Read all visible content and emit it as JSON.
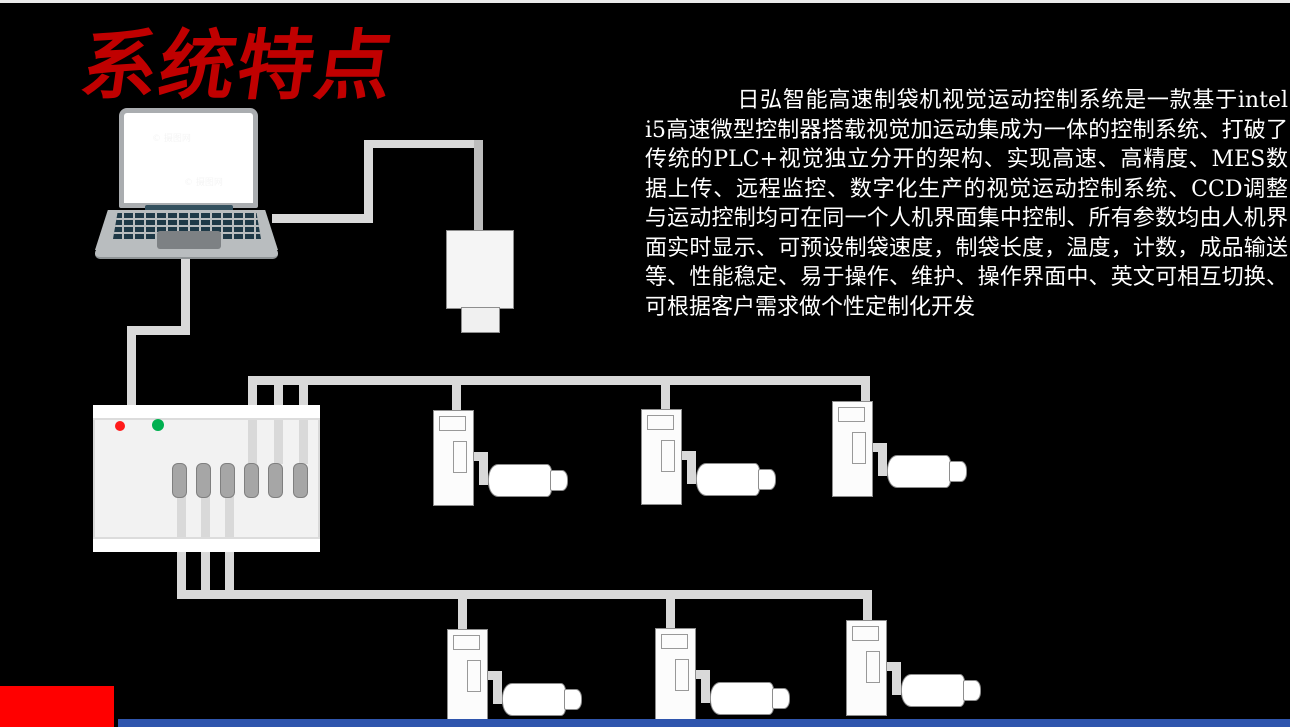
{
  "slide": {
    "title": "系统特点",
    "body_text": "日弘智能高速制袋机视觉运动控制系统是一款基于intel i5高速微型控制器搭载视觉加运动集成为一体的控制系统、打破了传统的PLC+视觉独立分开的架构、实现高速、高精度、MES数据上传、远程监控、数字化生产的视觉运动控制系统、CCD调整与运动控制均可在同一个人机界面集中控制、所有参数均由人机界面实时显示、可预设制袋速度，制袋长度，温度，计数，成品输送等、性能稳定、易于操作、维护、操作界面中、英文可相互切换、可根据客户需求做个性定制化开发",
    "watermark": "© 摄图网",
    "colors": {
      "background": "#000000",
      "title_red": "#c00000",
      "body_text": "#ffffff",
      "accent_block_red": "#ff0000",
      "bottom_bar_blue": "#2f55ad",
      "cable_gray": "#d9d9d9",
      "led_red": "#ff1a1a",
      "led_green": "#00b050"
    },
    "diagram": {
      "components": [
        "laptop",
        "industrial-camera",
        "motion-controller-with-leds",
        "servo-drive-with-motor (x6)"
      ]
    }
  }
}
